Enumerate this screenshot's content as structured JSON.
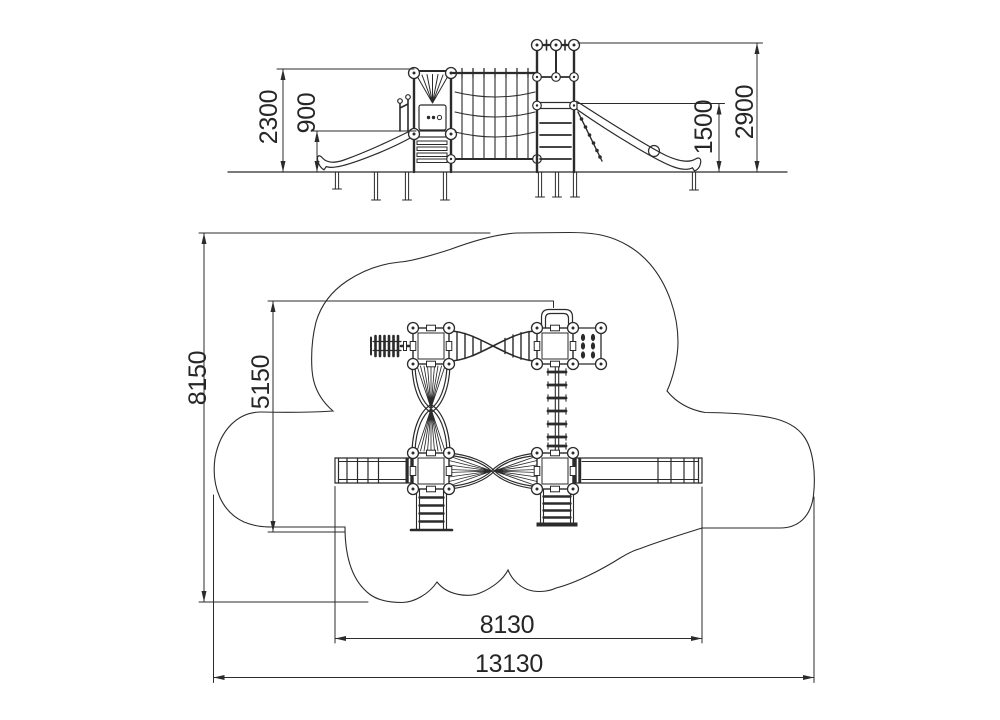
{
  "page": {
    "background": "#ffffff",
    "line_color": "#2b2b2b"
  },
  "elevation_view": {
    "description": "side elevation of playground structure",
    "dimensions": {
      "deck_height": "2300",
      "left_platform_height": "900",
      "right_platform_height": "1500",
      "overall_height": "2900"
    }
  },
  "plan_view": {
    "description": "top plan with cloud-shaped safety area",
    "dimensions": {
      "safety_zone_depth": "8150",
      "equipment_depth": "5150",
      "equipment_width": "8130",
      "safety_zone_width": "13130"
    }
  }
}
